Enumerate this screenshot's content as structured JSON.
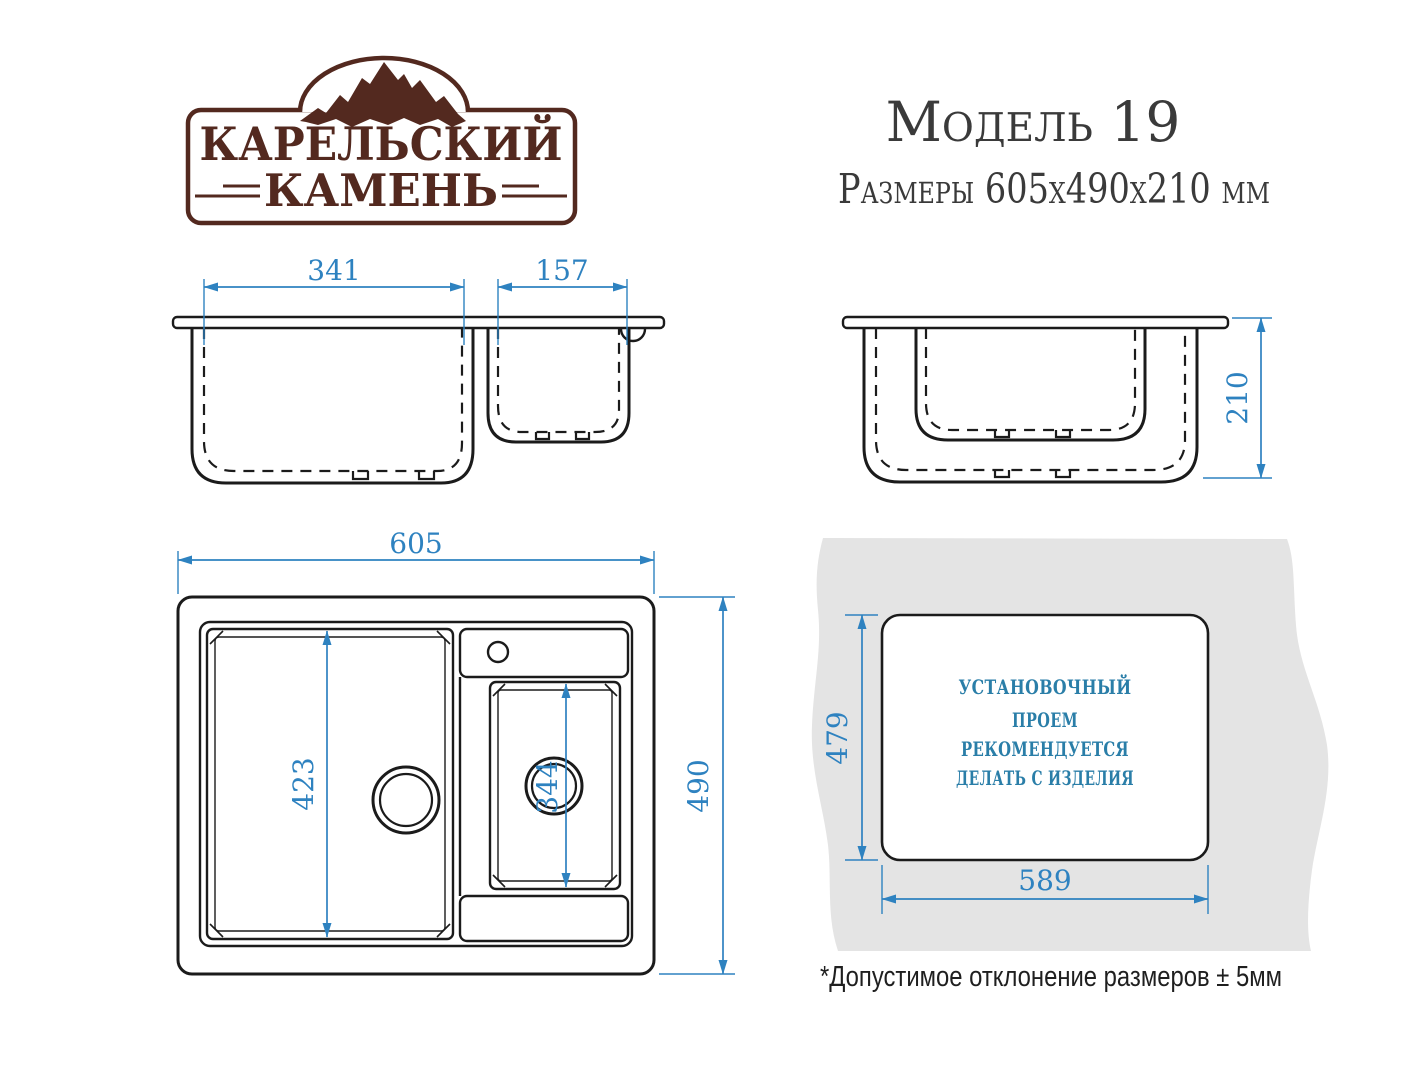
{
  "logo": {
    "line1": "КАРЕЛЬСКИЙ",
    "line2": "КАМЕНЬ",
    "icon": "mountains-icon"
  },
  "header": {
    "model": "Модель 19",
    "size_line": "Размеры 605х490х210 мм"
  },
  "dims": {
    "front_bowl_width": "341",
    "front_small_bowl_width": "157",
    "side_depth": "210",
    "top_width": "605",
    "top_height": "490",
    "top_bowl_length": "423",
    "top_small_bowl_length": "344",
    "cutout_height": "479",
    "cutout_width": "589"
  },
  "cutout_note": {
    "lines": [
      "УСТАНОВОЧНЫЙ",
      "ПРОЕМ",
      "РЕКОМЕНДУЕТСЯ",
      "ДЕЛАТЬ С ИЗДЕЛИЯ"
    ]
  },
  "footnote": "*Допустимое отклонение размеров ± 5мм",
  "colors": {
    "dimension_blue": "#2e82c0",
    "note_blue": "#2a7ea8",
    "logo_brown": "#53291f",
    "line_color": "#1b1b1b",
    "countertop_gray": "#e4e4e4",
    "background": "#ffffff"
  }
}
